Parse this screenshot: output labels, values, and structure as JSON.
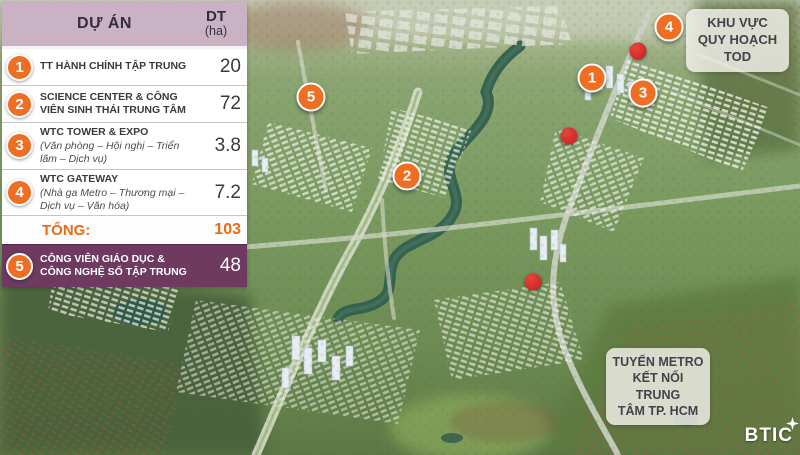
{
  "table": {
    "header": {
      "project": "DỰ ÁN",
      "area_line1": "DT",
      "area_line2": "(ha)"
    },
    "rows": [
      {
        "num": "1",
        "name": "TT HÀNH CHÍNH TẬP TRUNG",
        "desc": "",
        "value": "20"
      },
      {
        "num": "2",
        "name": "SCIENCE CENTER & CÔNG VIÊN SINH THÁI TRUNG TÂM",
        "desc": "",
        "value": "72"
      },
      {
        "num": "3",
        "name": "WTC TOWER & EXPO",
        "desc": "(Văn phòng – Hội nghị – Triển lãm – Dịch vụ)",
        "value": "3.8"
      },
      {
        "num": "4",
        "name": "WTC GATEWAY",
        "desc": "(Nhà ga Metro – Thương mại – Dịch vụ – Văn hóa)",
        "value": "7.2"
      }
    ],
    "total_row": {
      "label": "TỔNG:",
      "value": "103"
    },
    "highlight_row": {
      "num": "5",
      "name": "CÔNG VIÊN GIÁO DỤC & CÔNG NGHỆ SỐ TẬP TRUNG",
      "value": "48"
    }
  },
  "map": {
    "markers": [
      {
        "num": "1"
      },
      {
        "num": "2"
      },
      {
        "num": "3"
      },
      {
        "num": "4"
      },
      {
        "num": "5"
      }
    ],
    "tod_label": {
      "line1": "KHU VỰC",
      "line2": "QUY HOẠCH",
      "line3": "TOD"
    },
    "metro_label": {
      "line1": "TUYẾN METRO",
      "line2": "KẾT NỐI TRUNG",
      "line3": "TÂM TP. HCM"
    },
    "logo_text": "BTIC"
  },
  "colors": {
    "accent_orange": "#EE6F23",
    "header_mauve": "#C9B2C4",
    "highlight_plum": "#6E3A60",
    "total_orange": "#EE6A12",
    "station_red": "#C11F1F",
    "label_text": "#46404A"
  }
}
